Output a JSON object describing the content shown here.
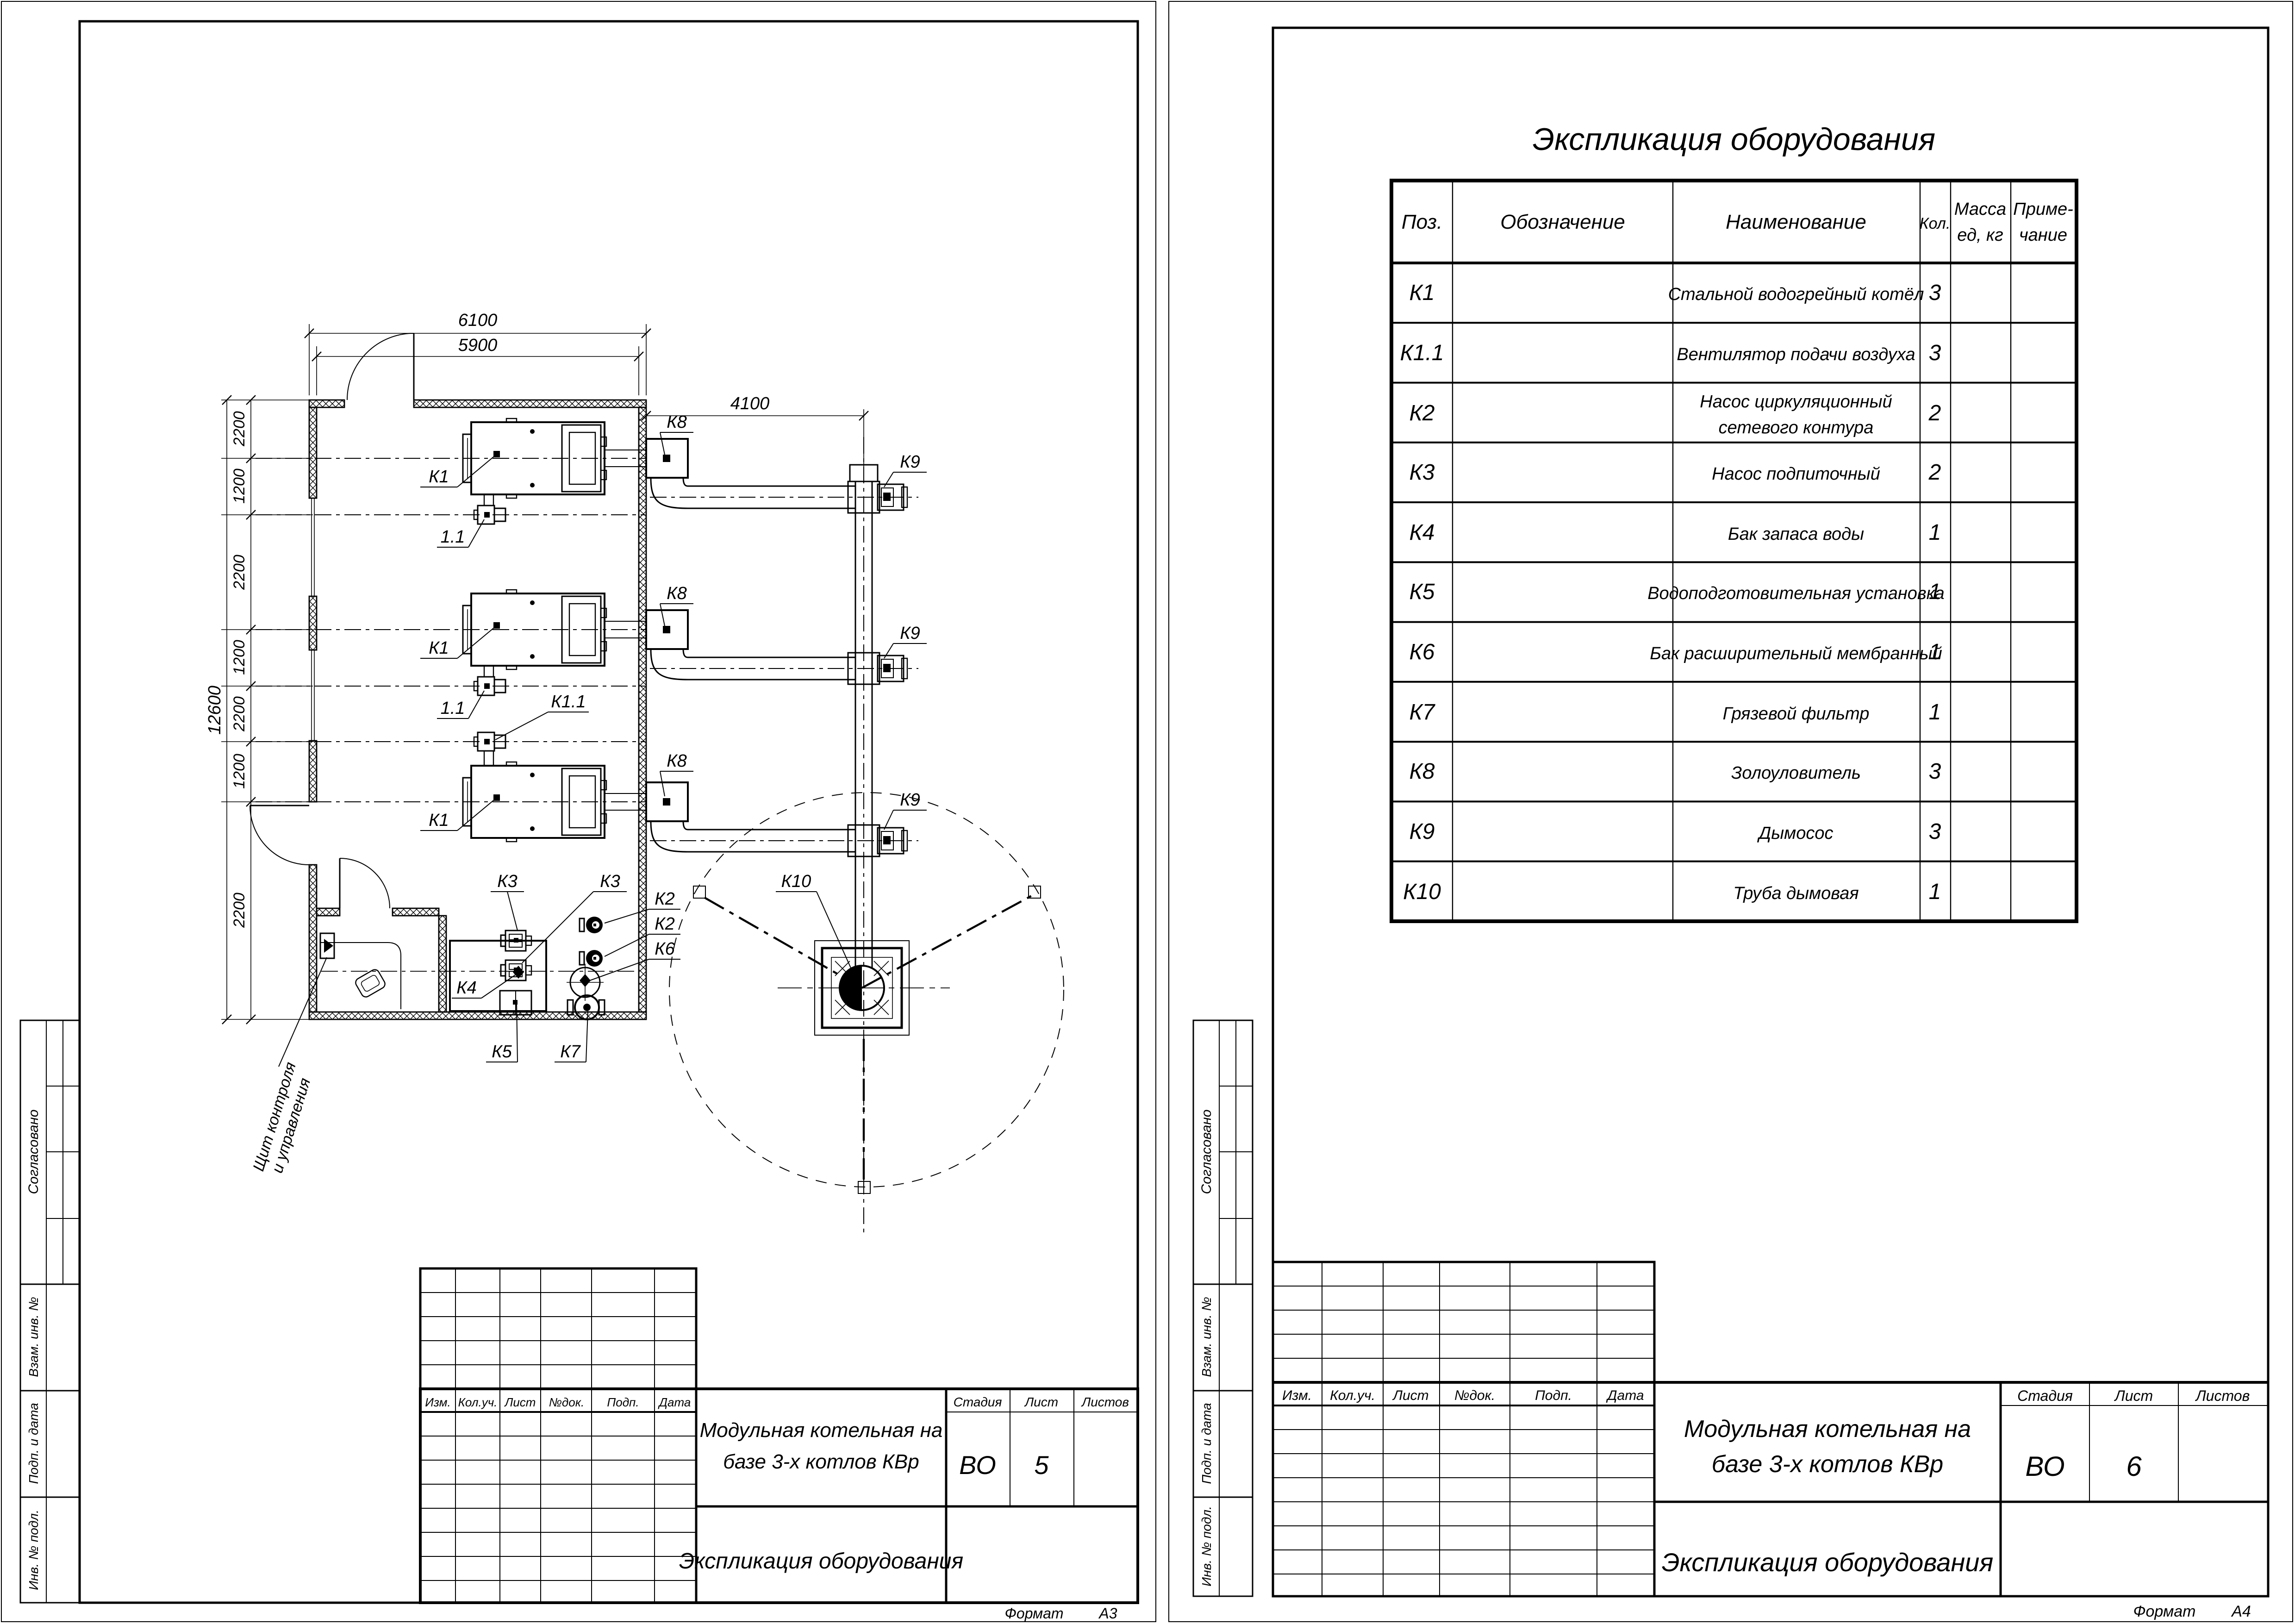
{
  "plan": {
    "dims": {
      "top_outer": "6100",
      "top_inner": "5900",
      "right": "4100",
      "overall": "12600",
      "chain": [
        "2200",
        "1200",
        "2200",
        "1200",
        "2200",
        "1200",
        "2200"
      ]
    },
    "labels": {
      "k1": "К1",
      "fan": "1.1",
      "k11": "К1.1",
      "k2": "К2",
      "k3": "К3",
      "k4": "К4",
      "k5": "К5",
      "k6": "К6",
      "k7": "К7",
      "k8": "К8",
      "k9": "К9",
      "k10": "К10"
    },
    "note_line1": "Щит контроля",
    "note_line2": "и управления"
  },
  "table": {
    "title": "Экспликация оборудования",
    "headers": {
      "pos": "Поз.",
      "designation": "Обозначение",
      "name": "Наименование",
      "qty": "Кол.",
      "mass1": "Масса",
      "mass2": "ед, кг",
      "note1": "Приме-",
      "note2": "чание"
    },
    "rows": [
      {
        "pos": "К1",
        "name": "Стальной водогрейный котёл",
        "name2": "",
        "qty": "3"
      },
      {
        "pos": "К1.1",
        "name": "Вентилятор подачи воздуха",
        "name2": "",
        "qty": "3"
      },
      {
        "pos": "К2",
        "name": "Насос циркуляционный",
        "name2": "сетевого контура",
        "qty": "2"
      },
      {
        "pos": "К3",
        "name": "Насос подпиточный",
        "name2": "",
        "qty": "2"
      },
      {
        "pos": "К4",
        "name": "Бак запаса воды",
        "name2": "",
        "qty": "1"
      },
      {
        "pos": "К5",
        "name": "Водоподготовительная установка",
        "name2": "",
        "qty": "1"
      },
      {
        "pos": "К6",
        "name": "Бак расширительный мембранный",
        "name2": "",
        "qty": "1"
      },
      {
        "pos": "К7",
        "name": "Грязевой фильтр",
        "name2": "",
        "qty": "1"
      },
      {
        "pos": "К8",
        "name": "Золоуловитель",
        "name2": "",
        "qty": "3"
      },
      {
        "pos": "К9",
        "name": "Дымосос",
        "name2": "",
        "qty": "3"
      },
      {
        "pos": "К10",
        "name": "Труба дымовая",
        "name2": "",
        "qty": "1"
      }
    ]
  },
  "titleblock": {
    "cols": {
      "izm": "Изм.",
      "koluch": "Кол.уч.",
      "list": "Лист",
      "ndok": "№док.",
      "podp": "Подп.",
      "data": "Дата"
    },
    "project_line1": "Модульная котельная на",
    "project_line2": "базе 3-х котлов КВр",
    "doc": "Экспликация оборудования",
    "stage_label": "Стадия",
    "sheet_label": "Лист",
    "sheets_label": "Листов",
    "stage": "ВО",
    "sheet_left": "5",
    "sheet_right": "6",
    "format_label": "Формат",
    "format_left": "А3",
    "format_right": "А4"
  },
  "sidebar": {
    "agreed": "Согласовано",
    "vzam": "Взам. инв. №",
    "podp": "Подп. и дата",
    "inv": "Инв. № подл."
  }
}
